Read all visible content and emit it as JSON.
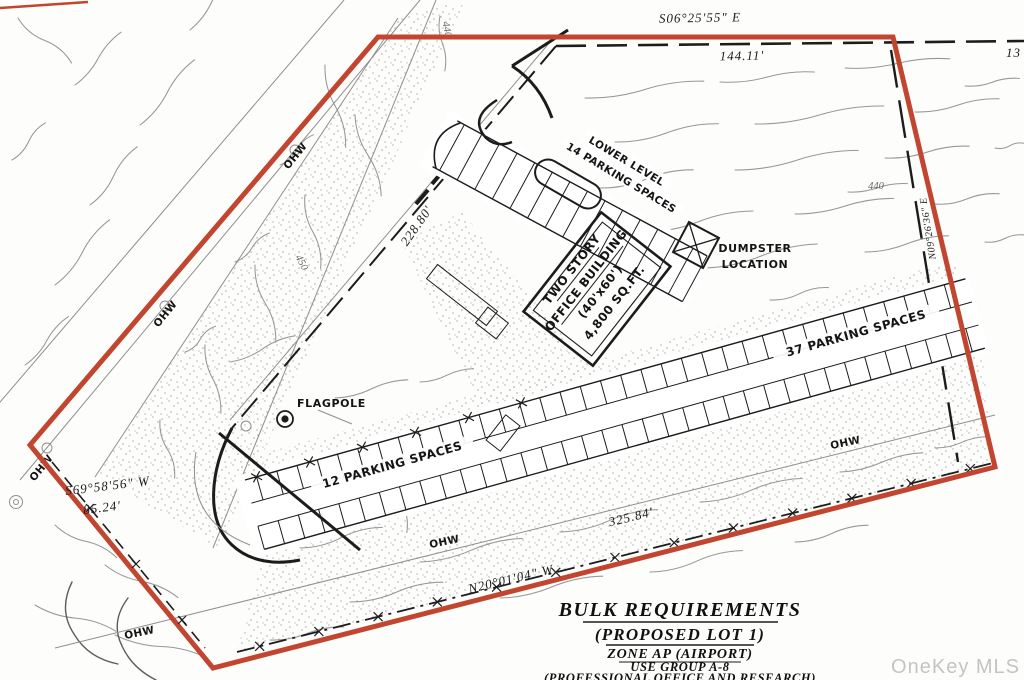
{
  "plan": {
    "survey": {
      "bearing_north": "S06°25'55\" E",
      "distance_north": "144.11'",
      "distance_northeast_fragment": "13",
      "bearing_east": "N09°26'36\" E",
      "bearing_southwest": "S69°58'56\" W",
      "distance_southwest": "85.24'",
      "bearing_south": "N20°01'04\" W",
      "distance_south": "325.84'",
      "distance_northwest": "228.80'"
    },
    "features": {
      "building_line1": "TWO STORY",
      "building_line2": "OFFICE BUILDING",
      "building_line3": "(40'x60')",
      "building_line4": "4,800 SQ.FT.",
      "lower_level_line1": "LOWER LEVEL",
      "lower_level_line2": "14 PARKING SPACES",
      "dumpster_line1": "DUMPSTER",
      "dumpster_line2": "LOCATION",
      "flagpole": "FLAGPOLE",
      "parking_long_row": "37 PARKING SPACES",
      "parking_short_row": "12 PARKING SPACES"
    },
    "annotations": {
      "overhead_wire": "OHW",
      "contour_440": "440",
      "contour_450": "450"
    },
    "title_block": {
      "line1": "BULK REQUIREMENTS",
      "line2": "(PROPOSED LOT 1)",
      "line3": "ZONE AP (AIRPORT)",
      "line4": "USE GROUP A-8",
      "line5": "(PROFESSIONAL OFFICE AND RESEARCH)"
    },
    "watermark": "OneKey MLS",
    "colors": {
      "boundary_red": "#c2462f",
      "ink": "#1c1c1c",
      "contour_gray": "#979797",
      "watermark_gray": "#c4c4c4"
    }
  }
}
